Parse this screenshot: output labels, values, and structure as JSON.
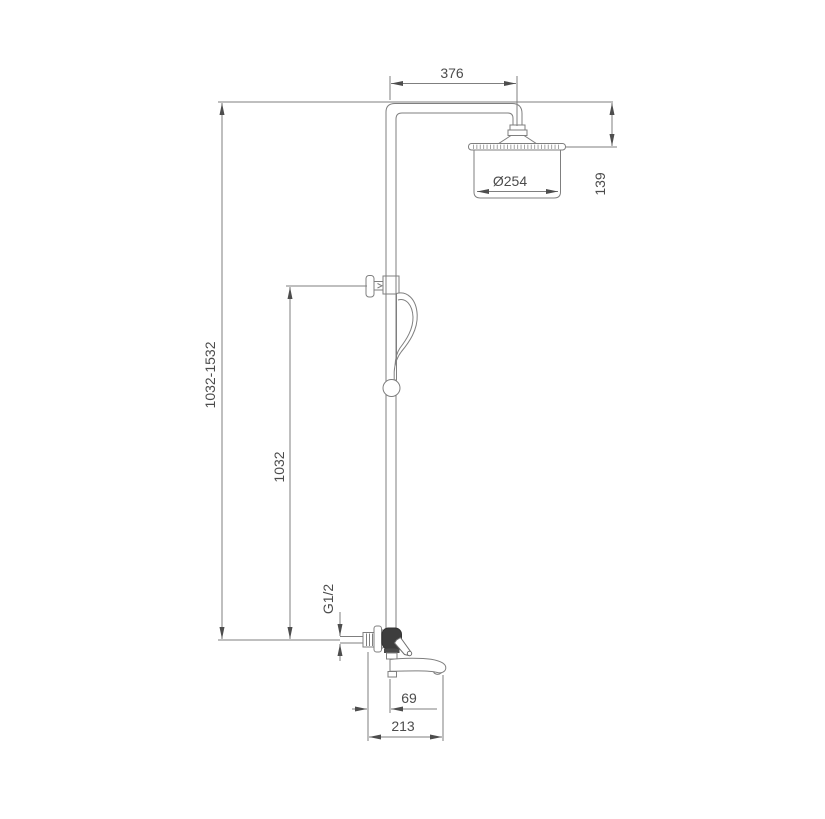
{
  "drawing": {
    "title": "shower-column-dimension-drawing",
    "dimensions": {
      "arm_length": "376",
      "head_diameter": "Ø254",
      "head_drop": "139",
      "height_range": "1032-1532",
      "riser_height": "1032",
      "inlet_thread": "G1/2",
      "spout_offset": "69",
      "spout_reach": "213"
    },
    "colors": {
      "background": "#ffffff",
      "line": "#7f7f7f",
      "text": "#4c4c4c",
      "arrow": "#4d4d4d",
      "valve_fill": "#3d3d3d"
    }
  }
}
